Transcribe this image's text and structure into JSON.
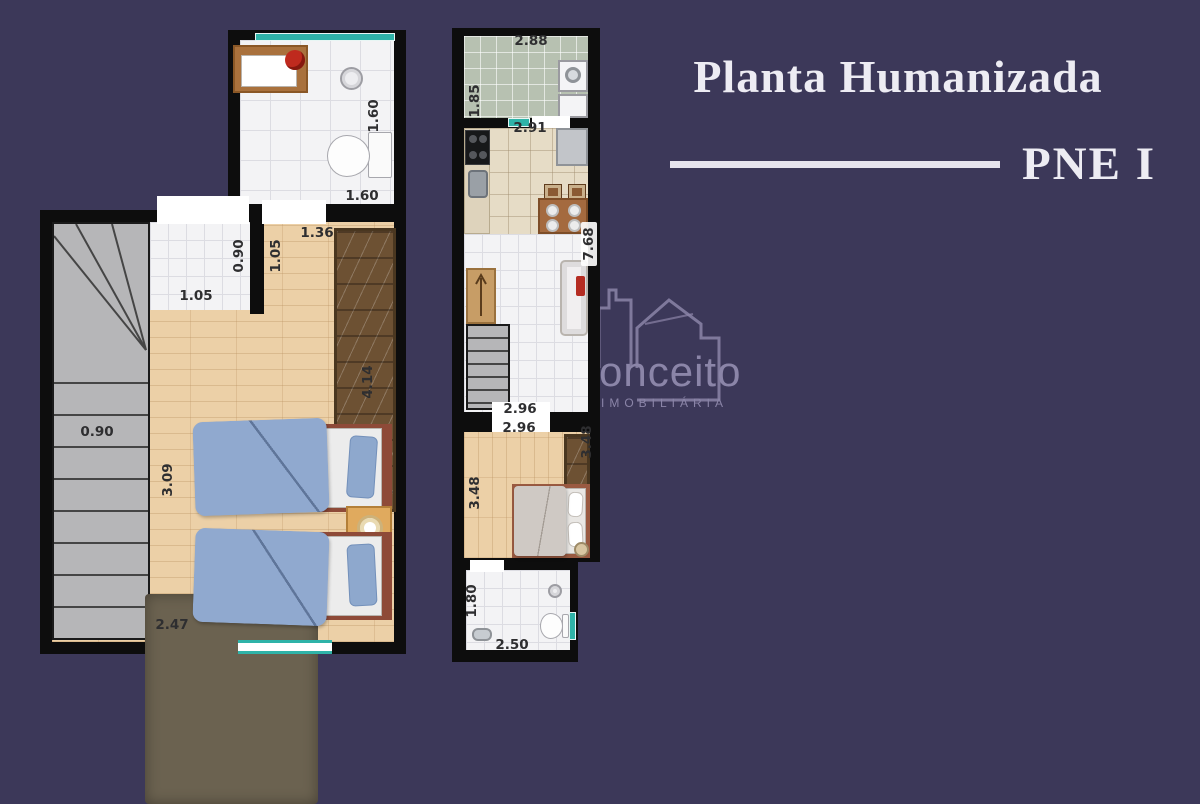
{
  "colors": {
    "background": "#3c3859",
    "wall": "#0d0d0d",
    "accent_teal": "#2fb3a8",
    "title_text": "#edecf3",
    "watermark": "#8b85a8",
    "wood_floor": "#ecd0a7",
    "tile_white": "#f3f3f5",
    "tile_sage": "#b7c1b1",
    "tile_beige": "#e6dcc6"
  },
  "title": {
    "heading": "Planta Humanizada",
    "subheading": "PNE I"
  },
  "watermark": {
    "brand": "onceito",
    "tagline": "IMOBILIÁRIA"
  },
  "upper_plan": {
    "dims": {
      "bath_depth": "1.60",
      "bath_width": "1.60",
      "entry_depth": "0.90",
      "entry_width": "1.05",
      "passage_width": "1.05",
      "closet_wall": "1.36",
      "room_length": "4.14",
      "stair_width": "0.90",
      "room_depth": "3.09",
      "room_width": "2.47"
    }
  },
  "lower_plan": {
    "dims": {
      "service_width": "2.88",
      "service_depth": "1.85",
      "kitchen_width": "2.91",
      "unit_length": "7.68",
      "living_width": "2.96",
      "bedroom_width": "2.96",
      "bedroom_depth_right": "3.48",
      "bedroom_depth_left": "3.48",
      "bath_depth": "1.80",
      "bath_width": "2.50"
    }
  }
}
